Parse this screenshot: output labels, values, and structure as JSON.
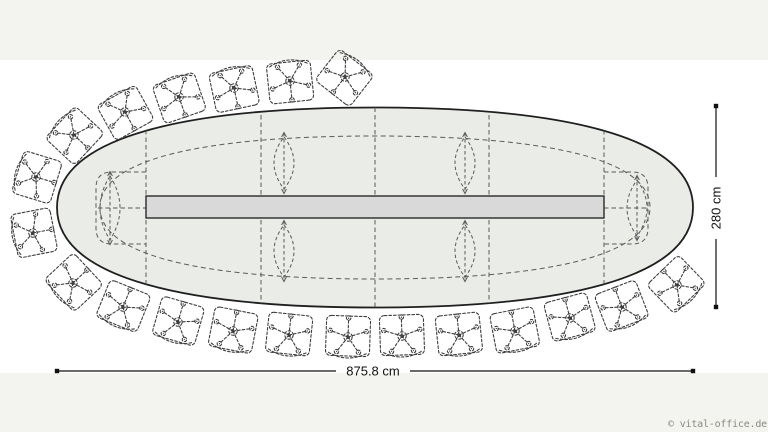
{
  "canvas": {
    "band_color": "#f3f3ef",
    "paper_color": "#ffffff"
  },
  "watermark": {
    "text": "© vital-office.de",
    "color": "#8a8a82"
  },
  "dimensions": {
    "width": {
      "label": "875.8 cm",
      "y": 371,
      "x1": 57,
      "x2": 693,
      "gap": [
        336,
        410
      ],
      "label_x": 373,
      "label_y": 375.5
    },
    "height": {
      "label": "280 cm",
      "x": 716,
      "y1": 106,
      "y2": 307,
      "gap": [
        177,
        239
      ],
      "label_x": 716,
      "label_y": 208
    }
  },
  "table": {
    "cx": 375,
    "cy": 207.5,
    "rx": 318,
    "ry": 100,
    "fill": "#eaece8",
    "stroke": "#1f1f1f",
    "inner_rx": 275,
    "inner_ry": 71.5,
    "channel": {
      "x": 146,
      "y": 196,
      "w": 458,
      "h": 22,
      "fill": "#d9d9d9",
      "stroke": "#2a2a2a"
    },
    "joints_x": [
      146,
      261,
      375,
      489,
      604
    ],
    "end_caps": [
      {
        "side": "left",
        "outer_x": 96,
        "joint_x": 146,
        "y1": 172,
        "y2": 244
      },
      {
        "side": "right",
        "outer_x": 648,
        "joint_x": 604,
        "y1": 172,
        "y2": 244
      }
    ],
    "legs": [
      {
        "x": 110,
        "y": 208,
        "h": 64
      },
      {
        "x": 284,
        "y": 163,
        "h": 52
      },
      {
        "x": 284,
        "y": 251,
        "h": 52
      },
      {
        "x": 465,
        "y": 163,
        "h": 52
      },
      {
        "x": 465,
        "y": 251,
        "h": 52
      },
      {
        "x": 637,
        "y": 208,
        "h": 56
      }
    ]
  },
  "chairs": [
    {
      "x": 36,
      "y": 177,
      "r": 107
    },
    {
      "x": 33,
      "y": 233,
      "r": 79
    },
    {
      "x": 74,
      "y": 135,
      "r": 133
    },
    {
      "x": 125,
      "y": 112,
      "r": 151
    },
    {
      "x": 179,
      "y": 97,
      "r": 161
    },
    {
      "x": 234,
      "y": 88,
      "r": 168
    },
    {
      "x": 290,
      "y": 81,
      "r": 174
    },
    {
      "x": 345,
      "y": 77,
      "r": 218
    },
    {
      "x": 73,
      "y": 283,
      "r": 47
    },
    {
      "x": 123,
      "y": 307,
      "r": 22
    },
    {
      "x": 178,
      "y": 322,
      "r": 16
    },
    {
      "x": 233,
      "y": 331,
      "r": 11
    },
    {
      "x": 289,
      "y": 335,
      "r": 6
    },
    {
      "x": 348,
      "y": 337,
      "r": 2
    },
    {
      "x": 402,
      "y": 336,
      "r": -2
    },
    {
      "x": 459,
      "y": 335,
      "r": -6
    },
    {
      "x": 515,
      "y": 331,
      "r": -11
    },
    {
      "x": 570,
      "y": 318,
      "r": -15
    },
    {
      "x": 622,
      "y": 307,
      "r": -21
    },
    {
      "x": 677,
      "y": 285,
      "r": -44
    }
  ],
  "style": {
    "dash_color": "#5a5a5a",
    "chair_color": "#3d3d3d",
    "dim_color": "#111111"
  }
}
